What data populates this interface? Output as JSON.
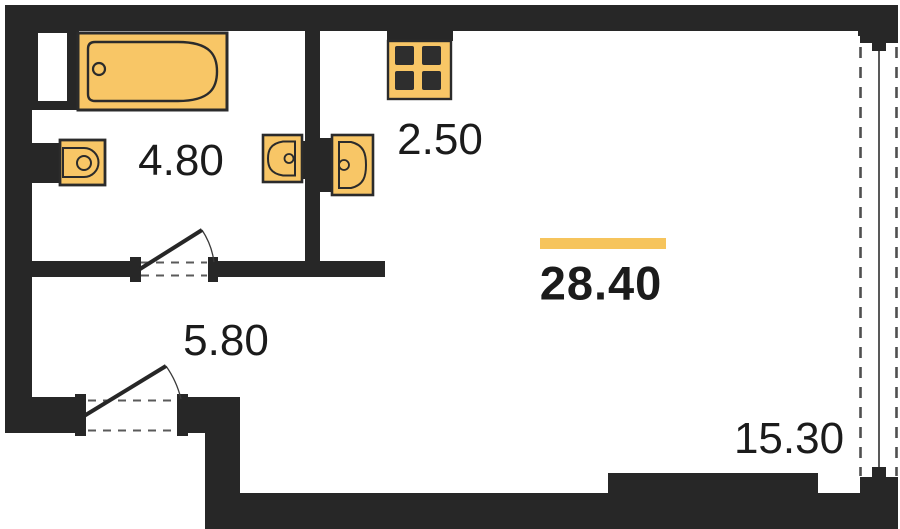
{
  "plan": {
    "type": "studio-apartment-floor-plan",
    "rooms": {
      "bathroom": {
        "area": "4.80"
      },
      "kitchen": {
        "area": "2.50"
      },
      "living": {
        "area": "28.40",
        "highlighted": true
      },
      "hall": {
        "area": "5.80"
      },
      "window_zone": {
        "area": "15.30"
      }
    },
    "fixtures": [
      "bathtub-icon",
      "toilet-icon",
      "washbasin-icon-left",
      "washbasin-icon-right",
      "stove-icon",
      "door-swing-icon-bathroom",
      "door-swing-icon-hall",
      "balcony-glazing-icon"
    ],
    "colors": {
      "wall": "#272727",
      "fixture_fill": "#f8c666",
      "fixture_stroke": "#2b2b2b",
      "accent_bar": "#f6c45c",
      "label_text": "#1b1b1b",
      "background": "#ffffff"
    }
  }
}
